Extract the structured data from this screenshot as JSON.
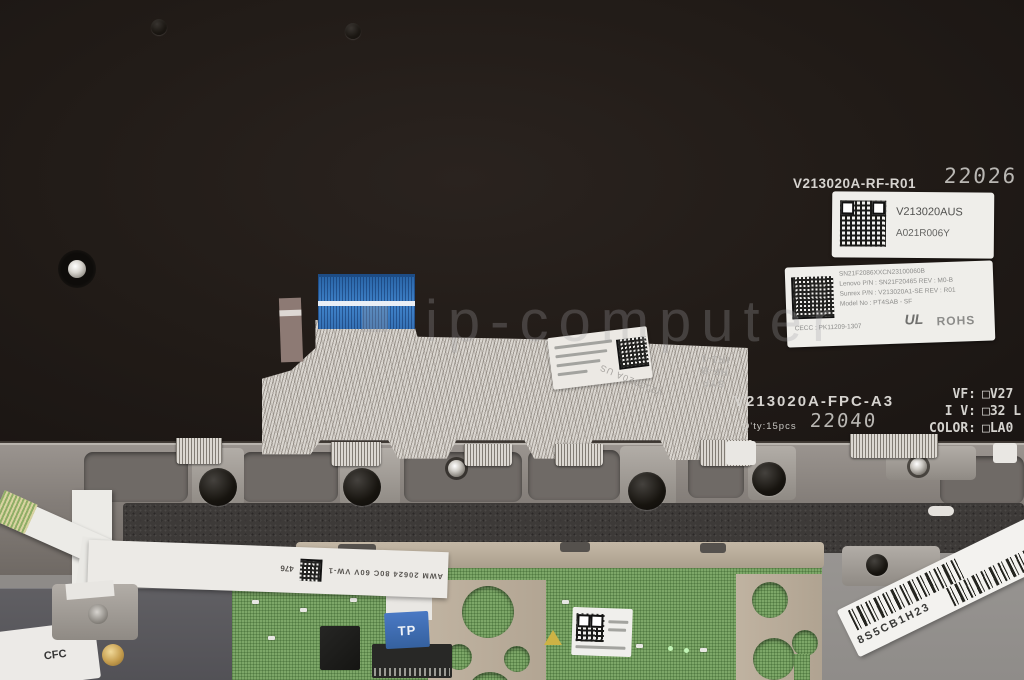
{
  "backplate": {
    "part_number": "V213020A-RF-R01",
    "date_stamp": "22026",
    "qr_label": {
      "pn": "V213020AUS",
      "rev": "A021R006Y"
    },
    "spec_label": {
      "serial": "SN21F2086XXCN23100060B",
      "row1": "Lenovo P/N : SN21F20465    REV : M0-B",
      "row2": "Sunrex P/N : V213020A1-SE   REV : R01",
      "row3": "Model No : PT4SAB - SF",
      "row4": "CECC : PK11209-1307",
      "ul": "UL",
      "rohs": "ROHS"
    },
    "fpc_label": {
      "part": "V213020A-FPC-A3",
      "qty": "Q'ty:15pcs",
      "date_stamp": "22040"
    },
    "flex_marks": {
      "line1": "SYF",
      "line2": "HF-B",
      "line3": "IR1-1",
      "part": "V213020A US"
    },
    "option_rows": [
      {
        "label": "VF:",
        "value": "□V27"
      },
      {
        "label": "I V:",
        "value": "□32 L"
      },
      {
        "label": "COLOR:",
        "value": "□LA0"
      }
    ]
  },
  "watermark": "ip-computer",
  "bottom": {
    "tp_sticker": "TP",
    "cable_marking": "AWM 20624 80C 60V VW-1",
    "cable_marking_num": "476",
    "barcode_label": "8S5CB1H23",
    "corner_label": "CFC"
  }
}
